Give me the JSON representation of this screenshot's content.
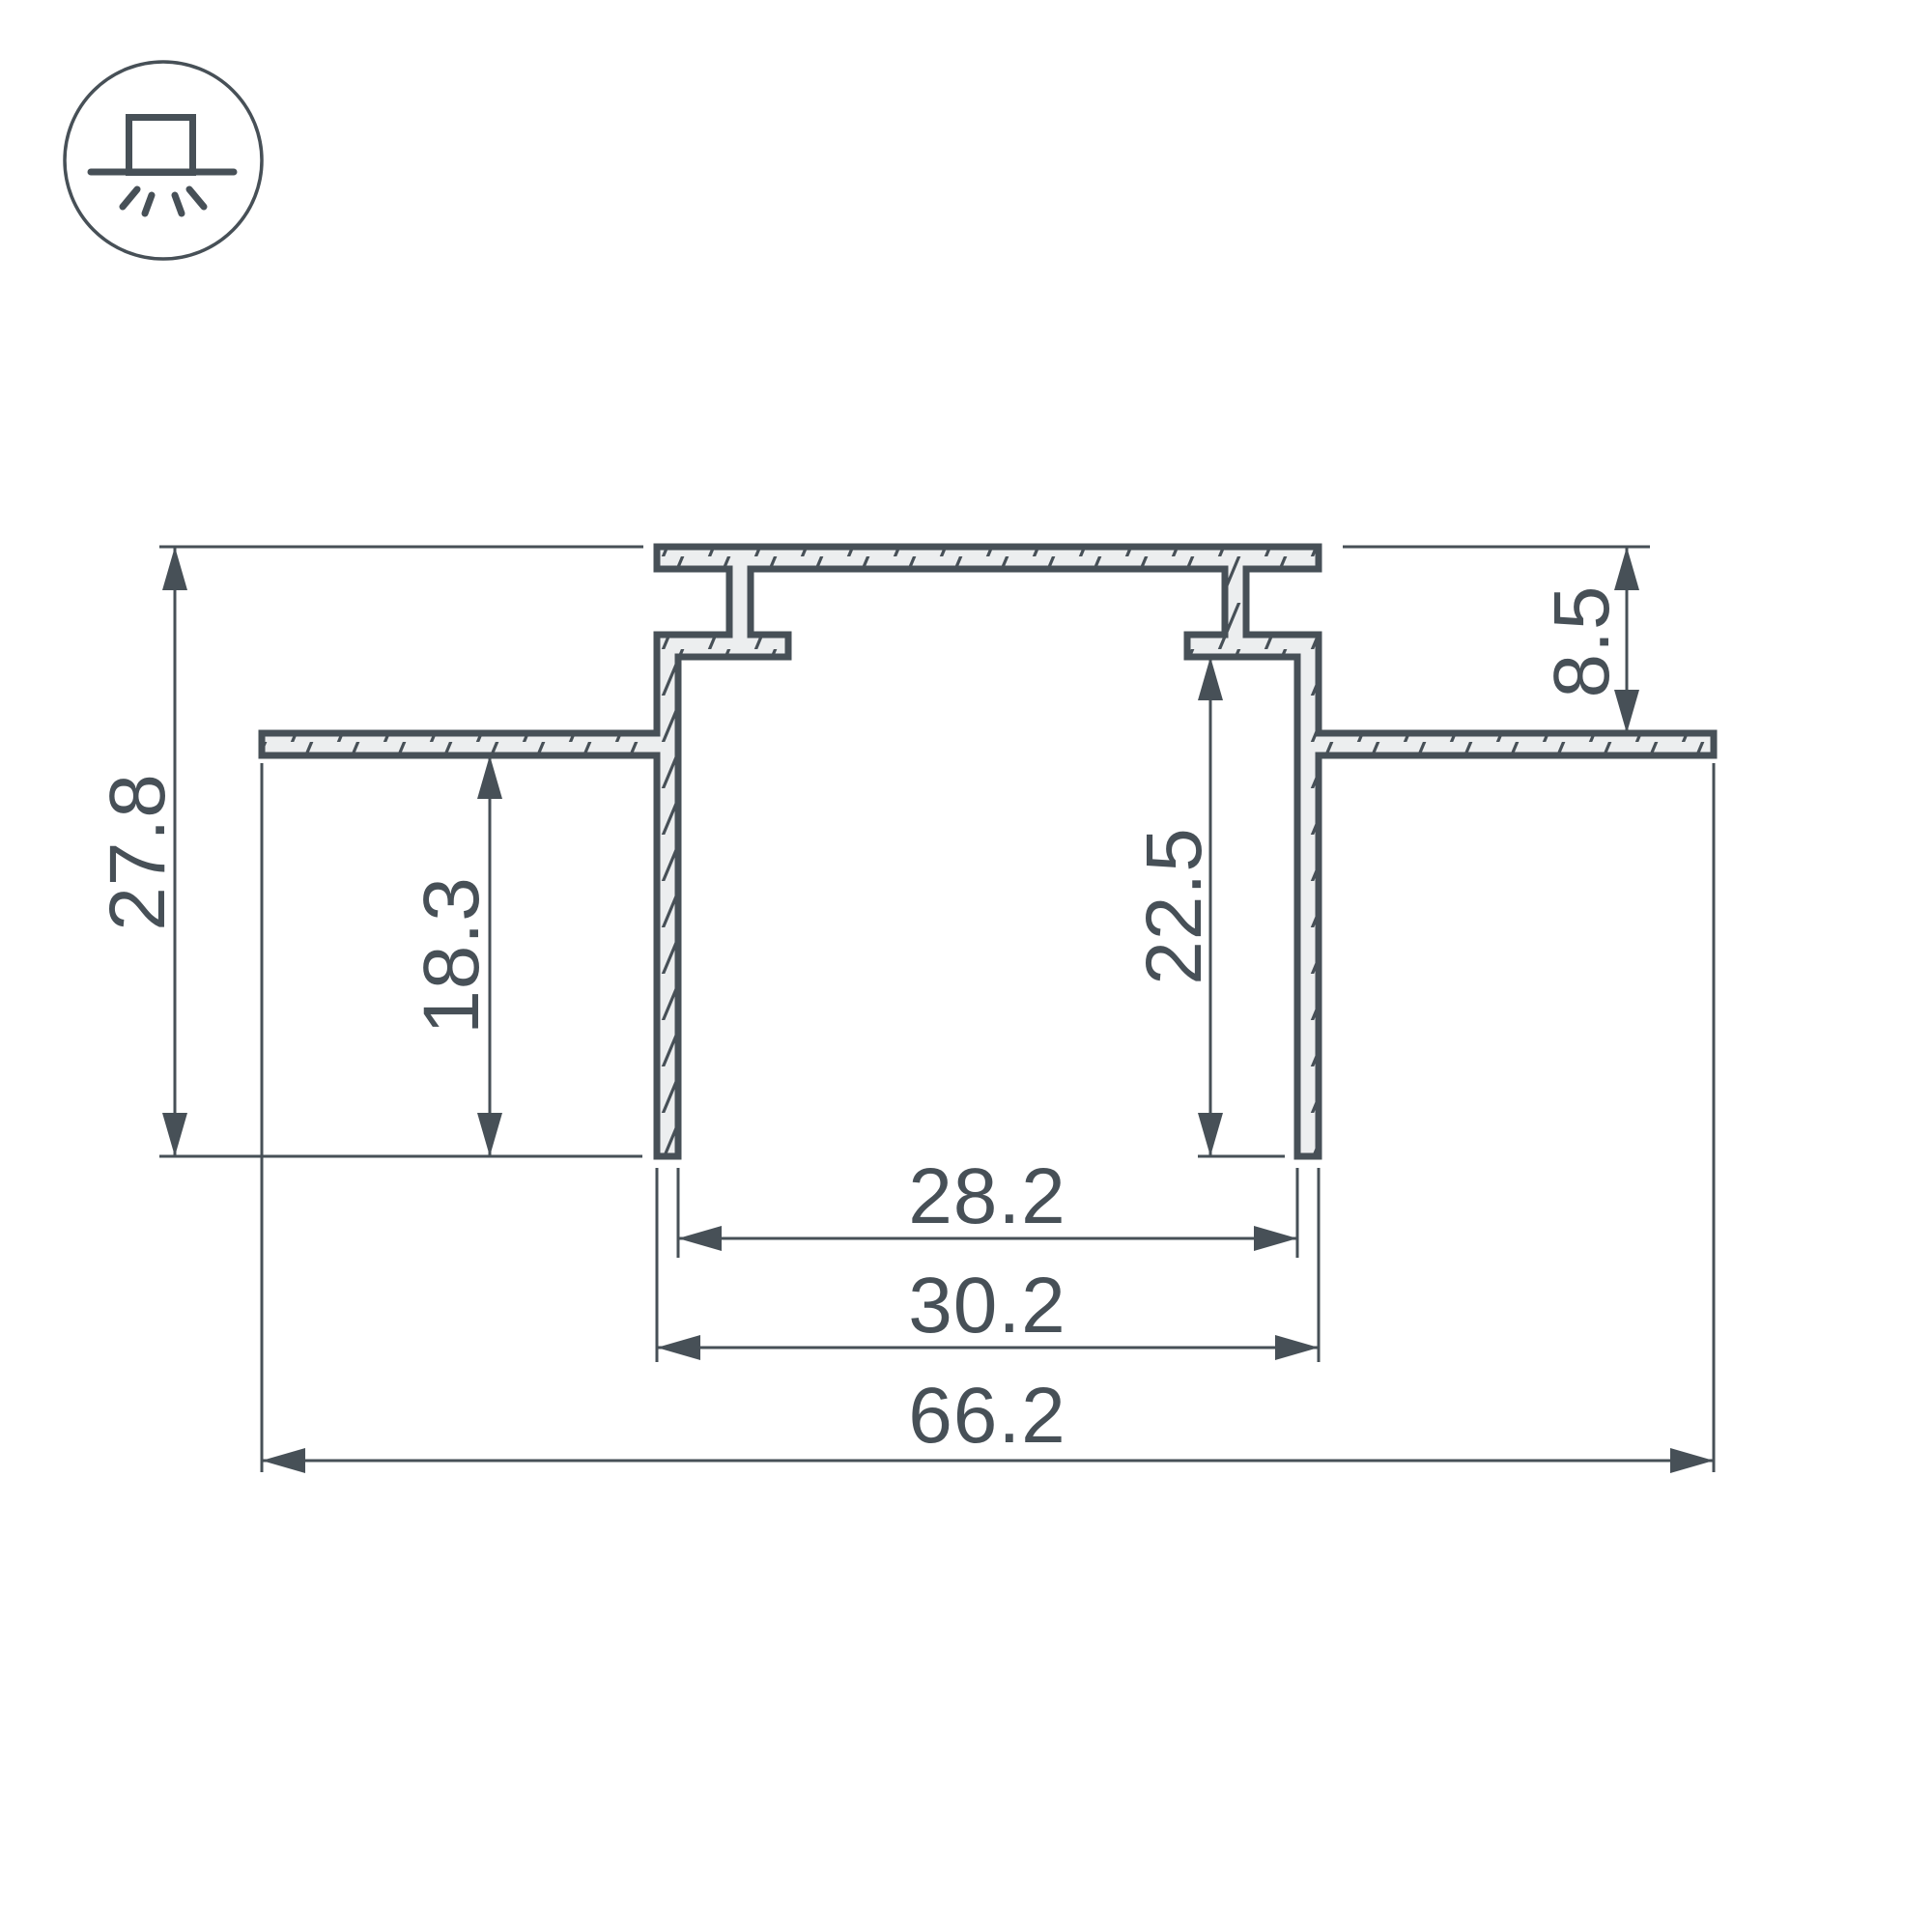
{
  "page": {
    "background_color": "#ffffff",
    "line_color": "#475057",
    "profile_fill_color": "#eceeef"
  },
  "drawing": {
    "title": "Recessed LED profile cross-section",
    "icon": {
      "name": "recessed-light-mounting-icon"
    },
    "dimensions_mm": {
      "overall_height": "27.8",
      "wing_to_bottom_depth": "18.3",
      "top_to_wing_height": "8.5",
      "inner_depth": "22.5",
      "inner_width": "28.2",
      "outer_width": "30.2",
      "overall_width": "66.2"
    }
  }
}
